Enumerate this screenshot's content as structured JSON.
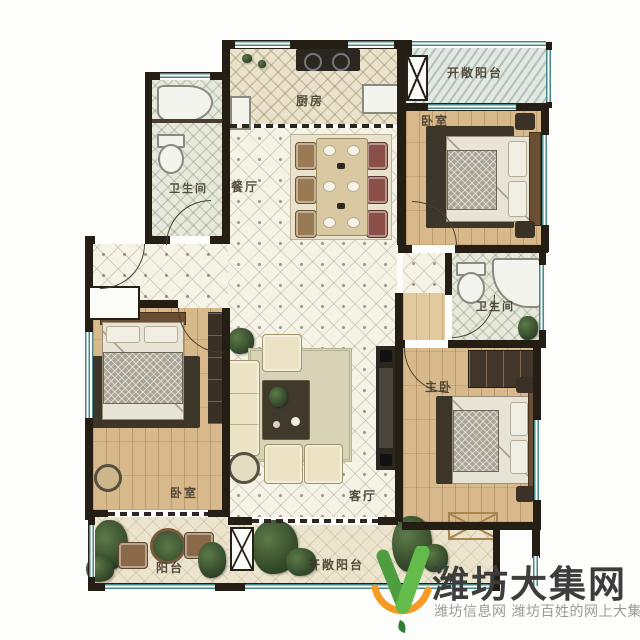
{
  "floor_plan": {
    "rooms": [
      {
        "key": "balcony-top-right",
        "label": "开敞阳台"
      },
      {
        "key": "bedroom-top-right",
        "label": "卧室"
      },
      {
        "key": "bathroom-top-left",
        "label": "卫生间"
      },
      {
        "key": "kitchen",
        "label": "厨房"
      },
      {
        "key": "dining-room",
        "label": "餐厅"
      },
      {
        "key": "bathroom-right",
        "label": "卫生间"
      },
      {
        "key": "master-bedroom",
        "label": "主卧"
      },
      {
        "key": "bedroom-bottom-left",
        "label": "卧室"
      },
      {
        "key": "living-room",
        "label": "客厅"
      },
      {
        "key": "balcony-bottom-left",
        "label": "阳台"
      },
      {
        "key": "balcony-bottom",
        "label": "开敞阳台"
      }
    ],
    "colors": {
      "wall": "#241e15",
      "window_frame": "#47888a",
      "wood_floor": "#d7b98b",
      "hall_tile": "#f5f2e6",
      "kitchen_floor": "#eae2ca",
      "bath_floor": "#e6e9dc",
      "balcony_floor": "#ece4cd",
      "rug": "#3c362a",
      "sofa": "#ebe3c3"
    }
  },
  "watermark": {
    "title": "潍坊大集网",
    "subtitle": "潍坊信息网 潍坊百姓的网上大集",
    "logo_icon": "v-check-swoosh-icon",
    "colors": {
      "title": "#3d3d3d",
      "subtitle": "#9a9a9a",
      "logo_green": "#57ab42",
      "logo_orange": "#f59a23"
    }
  }
}
